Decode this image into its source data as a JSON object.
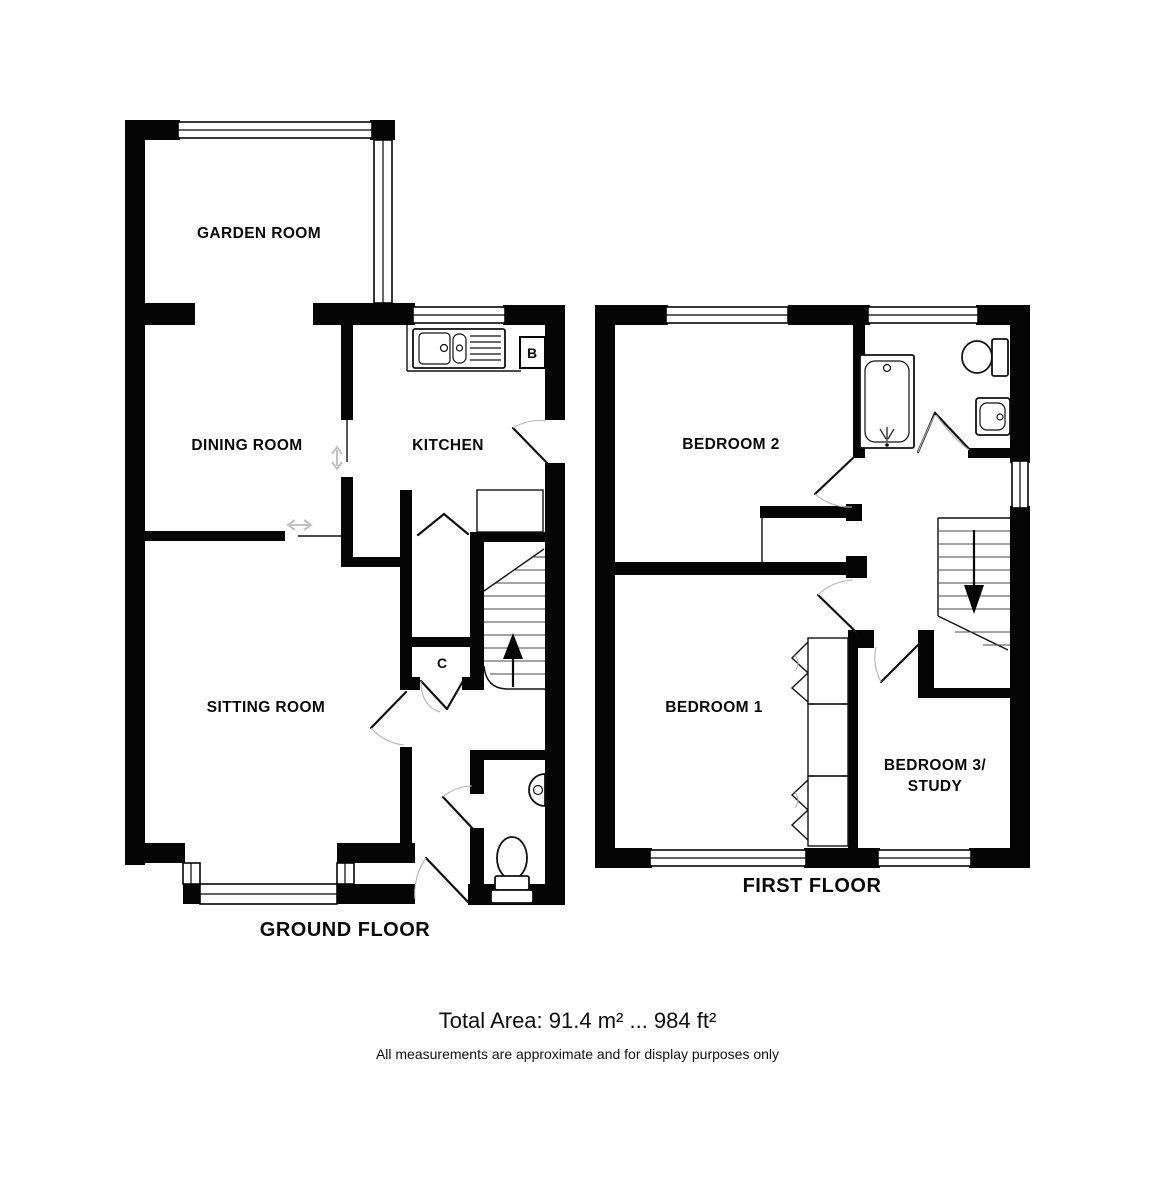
{
  "ground_floor": {
    "title": "GROUND FLOOR",
    "garden_room": "GARDEN ROOM",
    "dining_room": "DINING ROOM",
    "kitchen": "KITCHEN",
    "sitting_room": "SITTING ROOM",
    "cupboard": "C",
    "boiler": "B"
  },
  "first_floor": {
    "title": "FIRST FLOOR",
    "bedroom2": "BEDROOM 2",
    "bedroom1": "BEDROOM 1",
    "bedroom3_line1": "BEDROOM 3/",
    "bedroom3_line2": "STUDY"
  },
  "footer": {
    "total_area": "Total Area: 91.4 m² ... 984 ft²",
    "disclaimer": "All measurements are approximate and for display purposes only"
  },
  "colors": {
    "wall": "#050505",
    "background": "#ffffff",
    "door_arc": "#b4b4b4",
    "slide_arrow": "#c2c2c2"
  }
}
